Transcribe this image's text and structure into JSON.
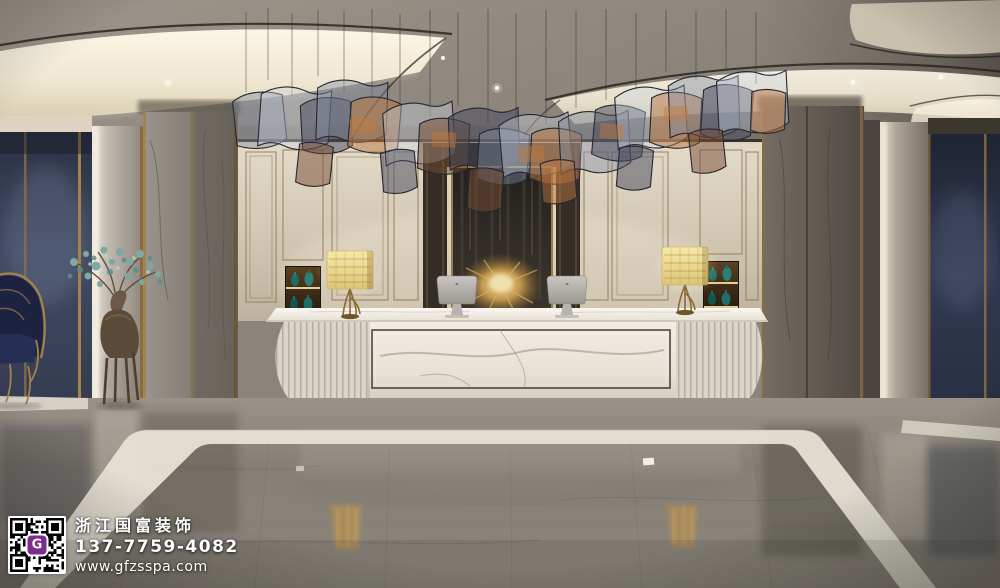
{
  "scene": {
    "description": "luxury hotel lobby reception with white marble desk, wavy glass ribbon chandelier, gold-framed cream wall panels, grey marble columns, navy fabric walls, bronze deer sculpture and polished grey marble floor",
    "objects": [
      "ceiling-cove-lights",
      "glass-ribbon-chandelier",
      "feature-wall-art",
      "reception-desk",
      "desk-lamp-left",
      "desk-lamp-right",
      "monitor-left",
      "monitor-right",
      "display-niche-left",
      "display-niche-right",
      "marble-column-left",
      "marble-column-right",
      "fabric-panel-left",
      "fabric-panel-right",
      "deer-sculpture",
      "canopy-chair",
      "marble-floor",
      "floor-inlay-border"
    ]
  },
  "palette": {
    "accent_gold": "#a5824a",
    "cove_light": "#f7f2e4",
    "marble_grey_floor": "#8d8880",
    "navy_fabric": "#3c4459",
    "teal_vase": "#1f6e66",
    "plinth_gold": "#c08a3c",
    "desk_marble": "#efece6",
    "qr_accent": "#7b2d8e"
  },
  "watermark": {
    "company": "浙江国富装饰",
    "phone": "137-7759-4082",
    "website": "www.gfzsspa.com",
    "qr_label": "G"
  }
}
